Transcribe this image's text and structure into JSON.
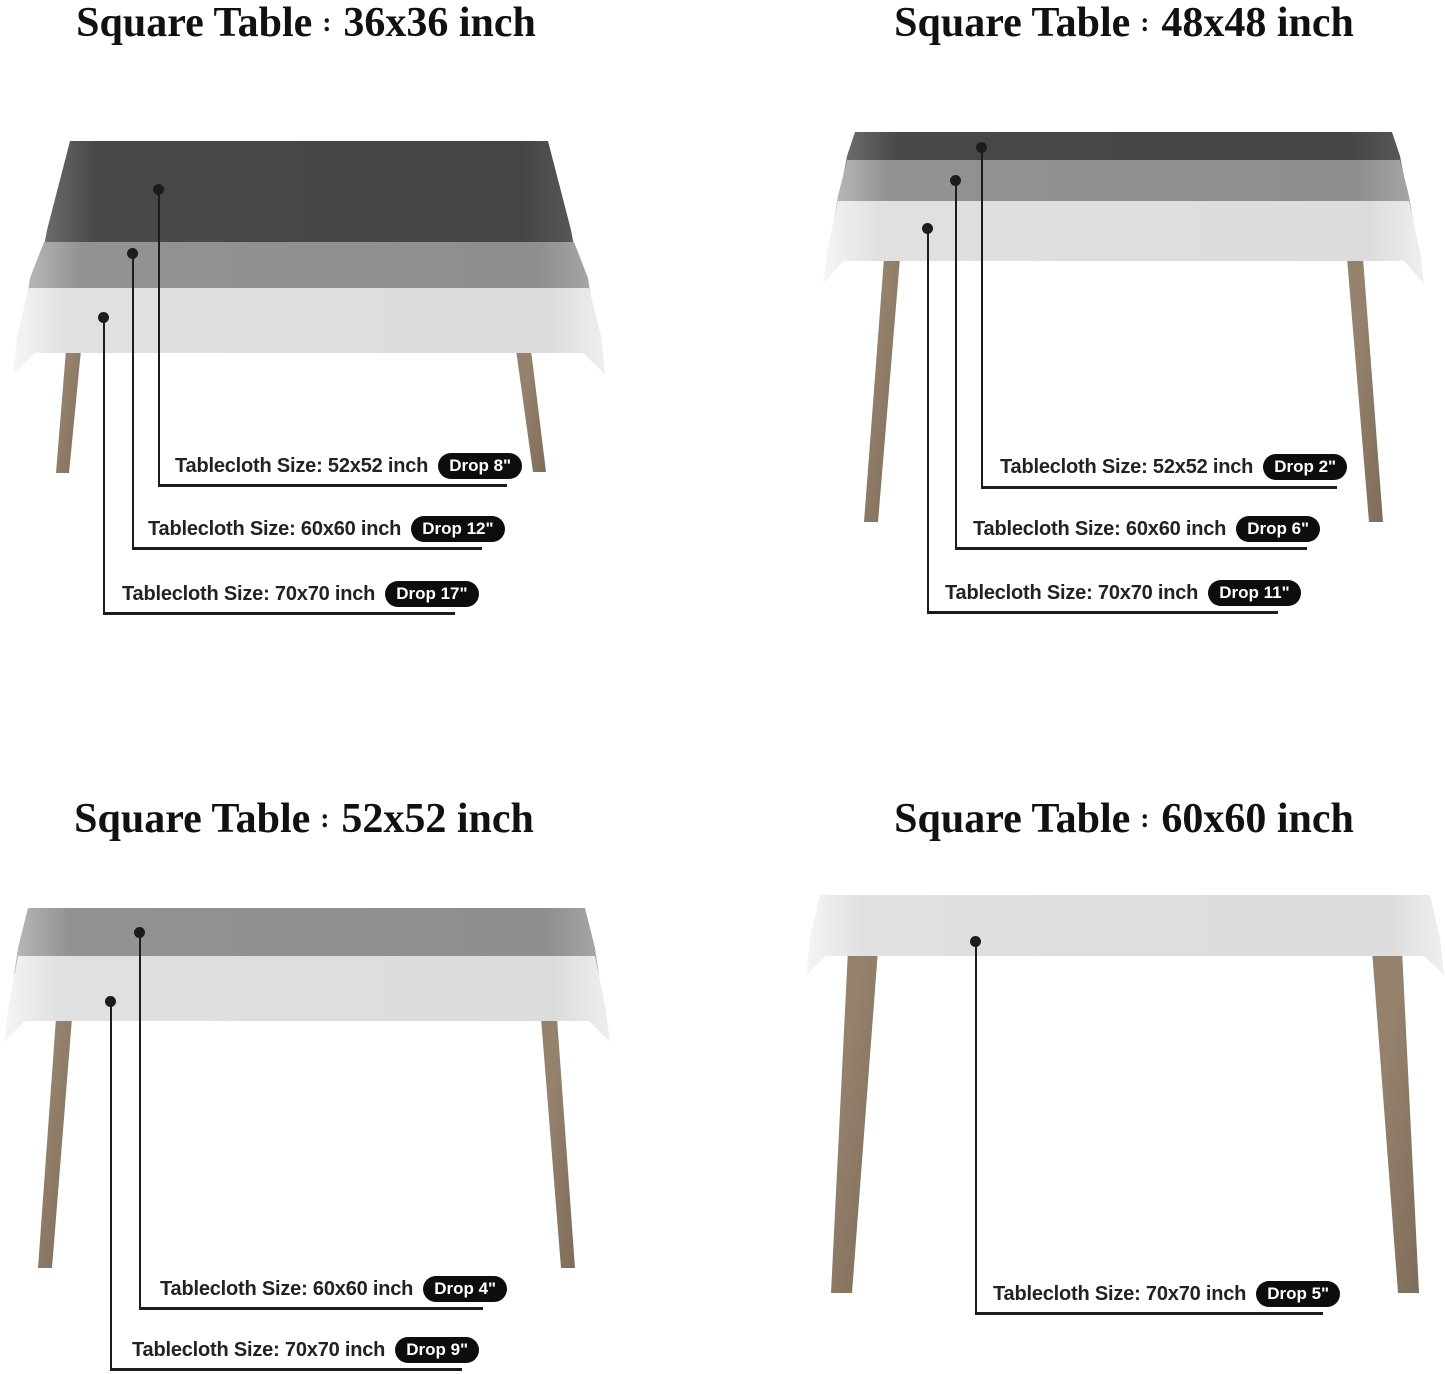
{
  "shared": {
    "title_separator": ":"
  },
  "colors": {
    "background": "#ffffff",
    "cloth_dark": "#474747",
    "cloth_medium": "#8f8f8f",
    "cloth_light": "#dedede",
    "table_leg": "#8a7866",
    "callout_line": "#1c1c1c",
    "drop_badge_bg": "#0d0d0d",
    "drop_badge_text": "#ffffff",
    "title_text": "#111111",
    "label_text": "#222222"
  },
  "sections": [
    {
      "title_prefix": "Square Table",
      "title_size": "36x36 inch",
      "callouts": [
        {
          "label": "Tablecloth Size: 52x52 inch",
          "drop": "Drop 8\""
        },
        {
          "label": "Tablecloth Size: 60x60 inch",
          "drop": "Drop 12\""
        },
        {
          "label": "Tablecloth Size: 70x70 inch",
          "drop": "Drop 17\""
        }
      ]
    },
    {
      "title_prefix": "Square Table",
      "title_size": "48x48 inch",
      "callouts": [
        {
          "label": "Tablecloth Size: 52x52 inch",
          "drop": "Drop 2\""
        },
        {
          "label": "Tablecloth Size: 60x60 inch",
          "drop": "Drop 6\""
        },
        {
          "label": "Tablecloth Size: 70x70 inch",
          "drop": "Drop 11\""
        }
      ]
    },
    {
      "title_prefix": "Square Table",
      "title_size": "52x52 inch",
      "callouts": [
        {
          "label": "Tablecloth Size: 60x60 inch",
          "drop": "Drop 4\""
        },
        {
          "label": "Tablecloth Size: 70x70 inch",
          "drop": "Drop 9\""
        }
      ]
    },
    {
      "title_prefix": "Square Table",
      "title_size": "60x60 inch",
      "callouts": [
        {
          "label": "Tablecloth Size: 70x70 inch",
          "drop": "Drop 5\""
        }
      ]
    }
  ]
}
